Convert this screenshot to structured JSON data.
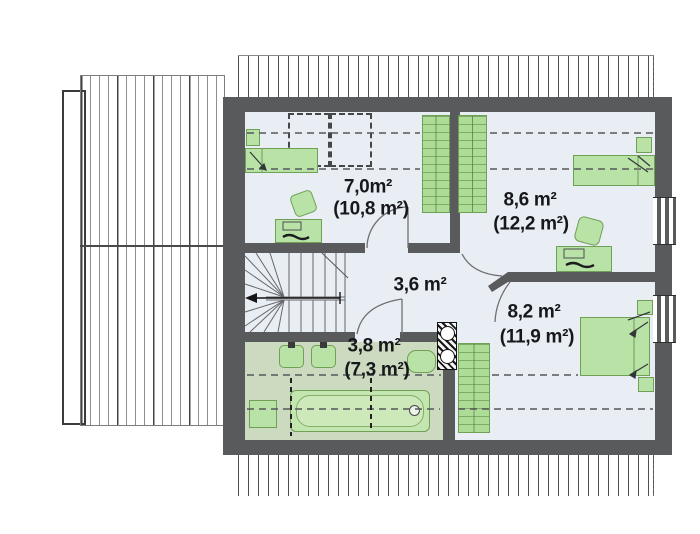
{
  "plan": {
    "type": "attic-floor-plan",
    "rooms": [
      {
        "name": "bedroom-left",
        "area": "7,0m²",
        "area_total": "(10,8 m²)",
        "furniture": [
          "single-bed",
          "nightstand",
          "desk",
          "chair",
          "wardrobe",
          "roof-window",
          "roof-window"
        ]
      },
      {
        "name": "bedroom-top-right",
        "area": "8,6 m²",
        "area_total": "(12,2 m²)",
        "furniture": [
          "single-bed",
          "nightstand",
          "desk",
          "chair",
          "wardrobe",
          "window"
        ]
      },
      {
        "name": "hall",
        "area": "3,6 m²",
        "area_total": "",
        "furniture": [
          "staircase"
        ]
      },
      {
        "name": "bedroom-bottom-right",
        "area": "8,2 m²",
        "area_total": "(11,9 m²)",
        "furniture": [
          "double-bed",
          "nightstand",
          "nightstand",
          "wardrobe",
          "window"
        ]
      },
      {
        "name": "bathroom",
        "area": "3,8 m²",
        "area_total": "(7,3 m²)",
        "furniture": [
          "sink",
          "sink",
          "toilet",
          "bathtub",
          "washer",
          "vent-shaft"
        ]
      }
    ]
  },
  "colors": {
    "wall": "#595a5c",
    "floor": "#e9edf4",
    "bath_floor": "#ccdbc0",
    "furn": "#b9e3a6",
    "furn_border": "#70a055",
    "line": "#555555"
  }
}
